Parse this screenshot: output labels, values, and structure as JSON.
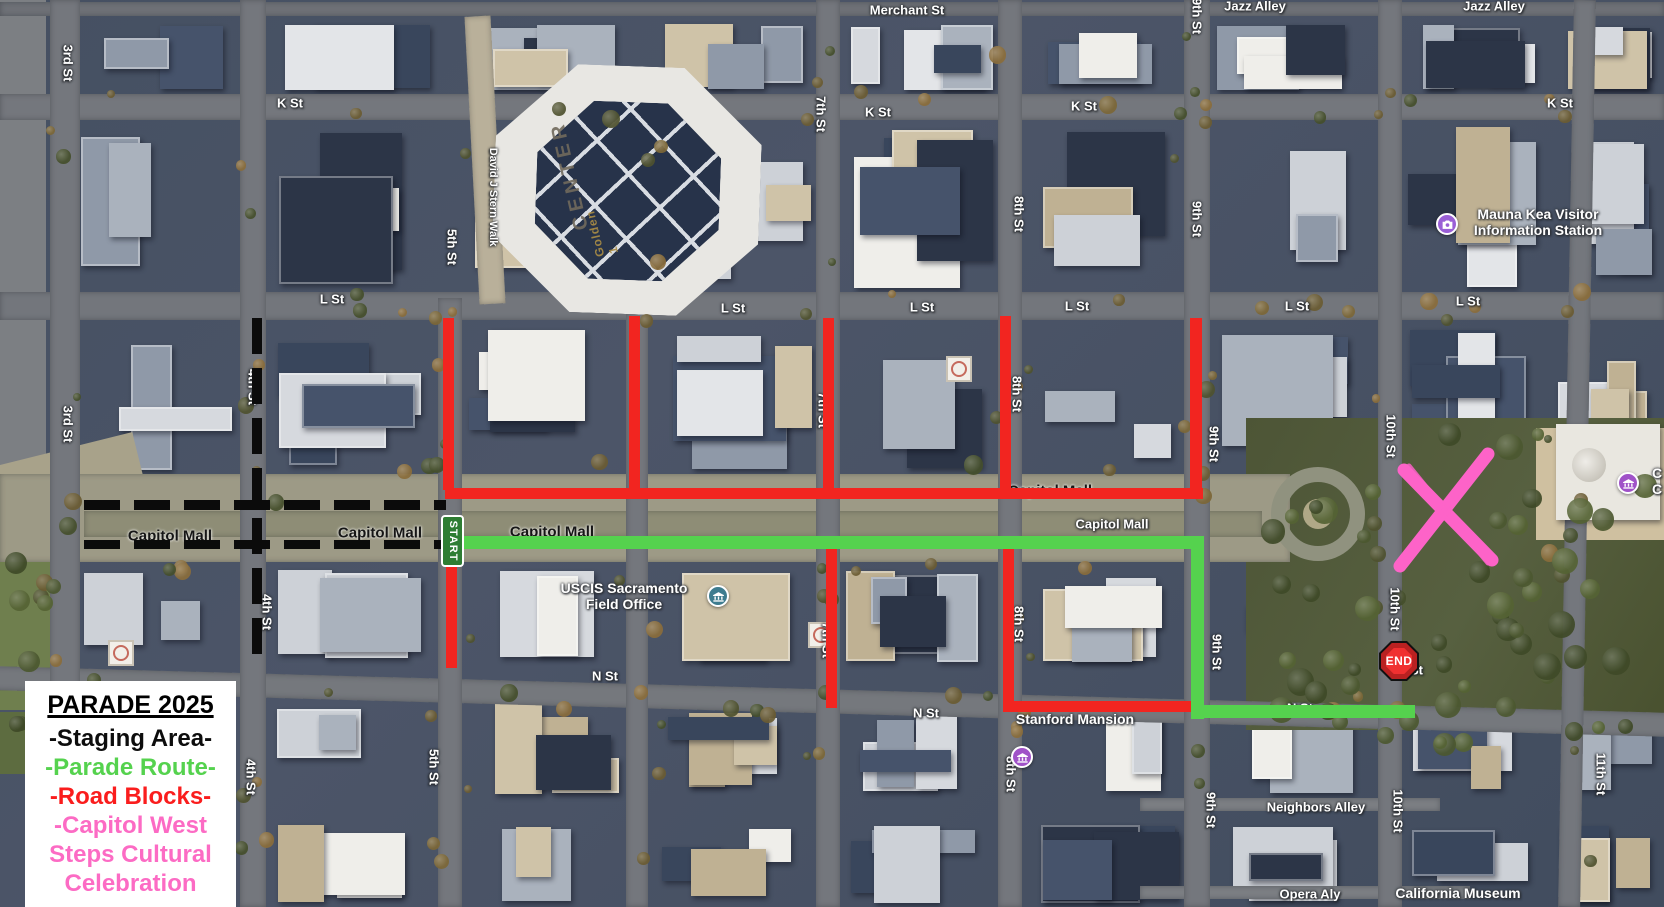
{
  "title": "Parade 2025 annotated satellite route map",
  "legend": {
    "title": "PARADE 2025",
    "items": [
      {
        "id": "staging",
        "lines": [
          "-Staging Area-"
        ],
        "color": "#0d0d0d"
      },
      {
        "id": "parade-route",
        "lines": [
          "-Parade Route-"
        ],
        "color": "#55d24e"
      },
      {
        "id": "road-blocks",
        "lines": [
          "-Road Blocks-"
        ],
        "color": "#fa1d1d"
      },
      {
        "id": "celebration",
        "lines": [
          "-Capitol West",
          "Steps Cultural",
          "Celebration"
        ],
        "color": "#fc6bc4"
      }
    ]
  },
  "markers": {
    "start": "START",
    "end": "END"
  },
  "streets": {
    "labels": [
      {
        "t": "K St",
        "x": 290,
        "y": 103
      },
      {
        "t": "K St",
        "x": 878,
        "y": 112
      },
      {
        "t": "K St",
        "x": 1084,
        "y": 106
      },
      {
        "t": "K St",
        "x": 1560,
        "y": 103
      },
      {
        "t": "L St",
        "x": 332,
        "y": 299
      },
      {
        "t": "L St",
        "x": 733,
        "y": 308
      },
      {
        "t": "L St",
        "x": 922,
        "y": 307
      },
      {
        "t": "L St",
        "x": 1077,
        "y": 306
      },
      {
        "t": "L St",
        "x": 1297,
        "y": 306
      },
      {
        "t": "L St",
        "x": 1468,
        "y": 301
      },
      {
        "t": "Capitol Mall",
        "x": 170,
        "y": 536,
        "dark": true
      },
      {
        "t": "Capitol Mall",
        "x": 380,
        "y": 533,
        "dark": true
      },
      {
        "t": "Capitol Mall",
        "x": 552,
        "y": 532,
        "dark": true
      },
      {
        "t": "Capitol Mall",
        "x": 1050,
        "y": 491,
        "dark": true
      },
      {
        "t": "Capitol Mall",
        "x": 1112,
        "y": 524
      },
      {
        "t": "N St",
        "x": 605,
        "y": 676
      },
      {
        "t": "N St",
        "x": 926,
        "y": 713
      },
      {
        "t": "N St",
        "x": 1300,
        "y": 708
      },
      {
        "t": "N St",
        "x": 1410,
        "y": 670
      },
      {
        "t": "Merchant St",
        "x": 907,
        "y": 10
      },
      {
        "t": "Jazz Alley",
        "x": 1255,
        "y": 6
      },
      {
        "t": "Jazz Alley",
        "x": 1494,
        "y": 6
      },
      {
        "t": "Neighbors Alley",
        "x": 1316,
        "y": 807
      },
      {
        "t": "Opera Aly",
        "x": 1310,
        "y": 894
      },
      {
        "t": "3rd St",
        "x": 68,
        "y": 63,
        "v": true
      },
      {
        "t": "3rd St",
        "x": 68,
        "y": 424,
        "v": true
      },
      {
        "t": "4th St",
        "x": 253,
        "y": 387,
        "v": true
      },
      {
        "t": "4th St",
        "x": 267,
        "y": 612,
        "v": true
      },
      {
        "t": "4th St",
        "x": 251,
        "y": 777,
        "v": true
      },
      {
        "t": "5th St",
        "x": 452,
        "y": 247,
        "v": true
      },
      {
        "t": "5th St",
        "x": 434,
        "y": 767,
        "v": true
      },
      {
        "t": "7th St",
        "x": 821,
        "y": 114,
        "v": true
      },
      {
        "t": "7th St",
        "x": 823,
        "y": 410,
        "v": true
      },
      {
        "t": "7th St",
        "x": 827,
        "y": 640,
        "v": true
      },
      {
        "t": "8th St",
        "x": 1019,
        "y": 214,
        "v": true
      },
      {
        "t": "8th St",
        "x": 1017,
        "y": 394,
        "v": true
      },
      {
        "t": "8th St",
        "x": 1019,
        "y": 624,
        "v": true
      },
      {
        "t": "8th St",
        "x": 1011,
        "y": 774,
        "v": true
      },
      {
        "t": "9th St",
        "x": 1197,
        "y": 16,
        "v": true
      },
      {
        "t": "9th St",
        "x": 1197,
        "y": 219,
        "v": true
      },
      {
        "t": "9th St",
        "x": 1214,
        "y": 444,
        "v": true
      },
      {
        "t": "9th St",
        "x": 1217,
        "y": 652,
        "v": true
      },
      {
        "t": "9th St",
        "x": 1211,
        "y": 810,
        "v": true
      },
      {
        "t": "10th St",
        "x": 1391,
        "y": 436,
        "v": true
      },
      {
        "t": "10th St",
        "x": 1395,
        "y": 609,
        "v": true
      },
      {
        "t": "10th St",
        "x": 1398,
        "y": 811,
        "v": true
      },
      {
        "t": "11th St",
        "x": 1601,
        "y": 774,
        "v": true
      },
      {
        "t": "David J Stern Walk",
        "x": 493,
        "y": 197,
        "v": true,
        "small": true
      }
    ]
  },
  "places": {
    "labels": [
      {
        "id": "uscis",
        "lines": [
          "USCIS Sacramento",
          "Field Office"
        ],
        "x": 624,
        "y": 596,
        "icon": "government",
        "icon_color": "#3e7c8f",
        "icon_x": 718,
        "icon_y": 596
      },
      {
        "id": "stanford-mansion",
        "lines": [
          "Stanford Mansion"
        ],
        "x": 1075,
        "y": 719,
        "icon": "government",
        "icon_color": "#a052c8",
        "icon_x": 1022,
        "icon_y": 757
      },
      {
        "id": "mauna-kea-visitor-information-station",
        "lines": [
          "Mauna Kea Visitor",
          "Information Station"
        ],
        "x": 1538,
        "y": 222,
        "icon": "camera",
        "icon_color": "#9a5fd6",
        "icon_x": 1447,
        "icon_y": 224
      },
      {
        "id": "capitol-partial",
        "lines": [
          "C",
          "C"
        ],
        "x": 1657,
        "y": 481,
        "icon": "government",
        "icon_color": "#a052c8",
        "icon_x": 1628,
        "icon_y": 483
      },
      {
        "id": "california-museum",
        "lines": [
          "California Museum"
        ],
        "x": 1458,
        "y": 893
      }
    ],
    "roof_labels": [
      {
        "t": "CENTER",
        "x": 570,
        "y": 175,
        "rot": -103,
        "gold": false
      },
      {
        "t": "Golden 1",
        "x": 602,
        "y": 232,
        "rot": -103,
        "gold": true
      }
    ]
  },
  "overlay": {
    "colors": {
      "staging": "#0b0b0b",
      "route": "#55d24e",
      "block": "#f22520",
      "celebration": "#fd63c8"
    },
    "route_segments": [
      {
        "x": 462,
        "y": 536,
        "w": 742,
        "h": 13
      },
      {
        "x": 1191,
        "y": 536,
        "w": 13,
        "h": 183
      },
      {
        "x": 1191,
        "y": 705,
        "w": 224,
        "h": 13
      }
    ],
    "block_segments": [
      {
        "x": 445,
        "y": 488,
        "w": 758,
        "h": 11
      },
      {
        "x": 443,
        "y": 318,
        "w": 11,
        "h": 172
      },
      {
        "x": 629,
        "y": 316,
        "w": 11,
        "h": 174
      },
      {
        "x": 823,
        "y": 318,
        "w": 11,
        "h": 172
      },
      {
        "x": 1000,
        "y": 316,
        "w": 11,
        "h": 174
      },
      {
        "x": 1190,
        "y": 318,
        "w": 12,
        "h": 172
      },
      {
        "x": 446,
        "y": 566,
        "w": 11,
        "h": 102
      },
      {
        "x": 826,
        "y": 545,
        "w": 11,
        "h": 163
      },
      {
        "x": 1003,
        "y": 545,
        "w": 11,
        "h": 158
      },
      {
        "x": 1003,
        "y": 701,
        "w": 190,
        "h": 11
      }
    ],
    "staging_segments": [
      {
        "x": 84,
        "y": 500,
        "w": 362,
        "h": 10,
        "dir": "h"
      },
      {
        "x": 84,
        "y": 540,
        "w": 360,
        "h": 9,
        "dir": "h"
      },
      {
        "x": 252,
        "y": 318,
        "w": 10,
        "h": 346,
        "dir": "v"
      }
    ],
    "start_sign": {
      "x": 441,
      "y": 515,
      "w": 23,
      "h": 52
    },
    "end_sign": {
      "x": 1379,
      "y": 641,
      "size": 40
    },
    "x_strokes": [
      {
        "x1": 1404,
        "y1": 470,
        "x2": 1492,
        "y2": 560,
        "w": 13
      },
      {
        "x1": 1488,
        "y1": 454,
        "x2": 1400,
        "y2": 566,
        "w": 13
      },
      {
        "x1": 1409,
        "y1": 466,
        "x2": 1488,
        "y2": 563,
        "w": 5
      },
      {
        "x1": 1484,
        "y1": 458,
        "x2": 1405,
        "y2": 561,
        "w": 5
      }
    ]
  }
}
